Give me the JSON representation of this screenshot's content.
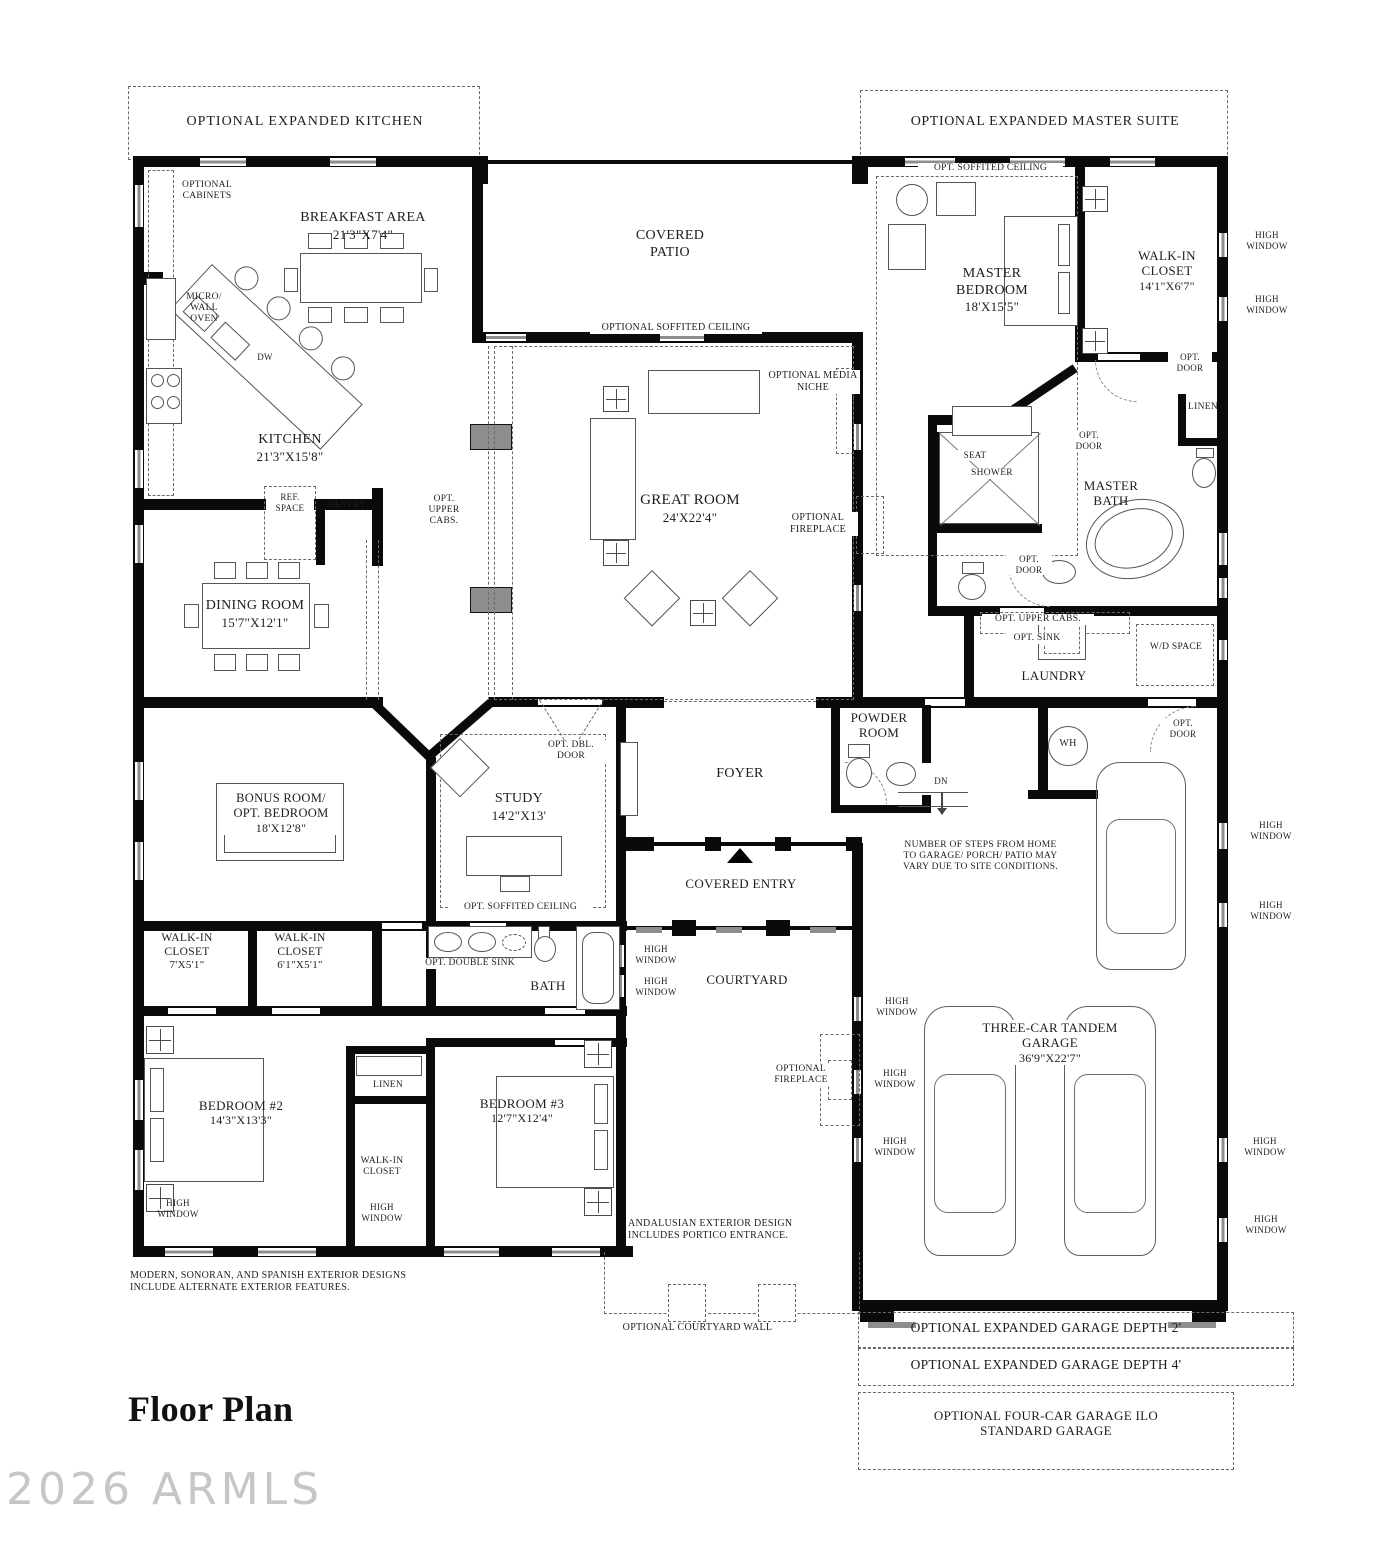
{
  "title": "Floor Plan",
  "watermark": "2026 ARMLS",
  "optional_areas": {
    "expanded_kitchen": "OPTIONAL EXPANDED KITCHEN",
    "expanded_master_suite": "OPTIONAL EXPANDED MASTER SUITE",
    "expanded_garage_depth_2": "OPTIONAL EXPANDED GARAGE DEPTH 2'",
    "expanded_garage_depth_4": "OPTIONAL EXPANDED GARAGE DEPTH 4'",
    "four_car_garage": "OPTIONAL FOUR-CAR GARAGE ILO STANDARD GARAGE",
    "courtyard_wall": "OPTIONAL COURTYARD WALL"
  },
  "rooms": {
    "breakfast_area": {
      "name": "BREAKFAST AREA",
      "dims": "21'3\"X7'4\""
    },
    "kitchen": {
      "name": "KITCHEN",
      "dims": "21'3\"X15'8\""
    },
    "covered_patio": {
      "name": "COVERED PATIO"
    },
    "great_room": {
      "name": "GREAT ROOM",
      "dims": "24'X22'4\""
    },
    "master_bedroom": {
      "name": "MASTER BEDROOM",
      "dims": "18'X15'5\""
    },
    "master_walk_in_closet": {
      "name": "WALK-IN CLOSET",
      "dims": "14'1\"X6'7\""
    },
    "master_bath": {
      "name": "MASTER BATH"
    },
    "dining_room": {
      "name": "DINING ROOM",
      "dims": "15'7\"X12'1\""
    },
    "laundry": {
      "name": "LAUNDRY"
    },
    "powder_room": {
      "name": "POWDER ROOM"
    },
    "bonus_room": {
      "name": "BONUS ROOM/ OPT. BEDROOM",
      "dims": "18'X12'8\""
    },
    "study": {
      "name": "STUDY",
      "dims": "14'2\"X13'"
    },
    "foyer": {
      "name": "FOYER"
    },
    "covered_entry": {
      "name": "COVERED ENTRY"
    },
    "walk_in_closet_2": {
      "name": "WALK-IN CLOSET",
      "dims": "7'X5'1\""
    },
    "walk_in_closet_3": {
      "name": "WALK-IN CLOSET",
      "dims": "6'1\"X5'1\""
    },
    "bath": {
      "name": "BATH"
    },
    "courtyard": {
      "name": "COURTYARD"
    },
    "bedroom_2": {
      "name": "BEDROOM #2",
      "dims": "14'3\"X13'3\""
    },
    "bedroom_3": {
      "name": "BEDROOM #3",
      "dims": "12'7\"X12'4\""
    },
    "bedroom_3_closet": {
      "name": "WALK-IN CLOSET"
    },
    "garage": {
      "name": "THREE-CAR TANDEM GARAGE",
      "dims": "36'9\"X22'7\""
    }
  },
  "features": {
    "optional_cabinets": "OPTIONAL CABINETS",
    "micro_wall_oven": "MICRO/ WALL OVEN",
    "dw": "DW",
    "ref_space": "REF. SPACE",
    "pantry": "PANTRY",
    "opt_upper_cabs": "OPT. UPPER CABS.",
    "optional_soffited_ceiling": "OPTIONAL SOFFITED CEILING",
    "opt_soffited_ceiling": "OPT. SOFFITED CEILING",
    "optional_media_niche": "OPTIONAL MEDIA NICHE",
    "optional_fireplace": "OPTIONAL FIREPLACE",
    "high_window": "HIGH WINDOW",
    "opt_door": "OPT. DOOR",
    "opt_dbl_door": "OPT. DBL. DOOR",
    "opt_double_sink": "OPT. DOUBLE SINK",
    "opt_sink": "OPT. SINK",
    "wd_space": "W/D SPACE",
    "linen": "LINEN",
    "seat": "SEAT",
    "shower": "SHOWER",
    "wh": "WH",
    "dn": "DN"
  },
  "notes": {
    "steps": "NUMBER OF STEPS FROM HOME TO GARAGE/ PORCH/ PATIO MAY VARY DUE TO SITE CONDITIONS.",
    "exterior_designs": "MODERN, SONORAN, AND SPANISH EXTERIOR DESIGNS INCLUDE ALTERNATE EXTERIOR FEATURES.",
    "andalusian": "ANDALUSIAN EXTERIOR DESIGN INCLUDES PORTICO ENTRANCE."
  },
  "colors": {
    "wall": "#0a0a0a",
    "line": "#555555",
    "sill": "#8e8e8e",
    "watermark": "#c6c6c6"
  }
}
